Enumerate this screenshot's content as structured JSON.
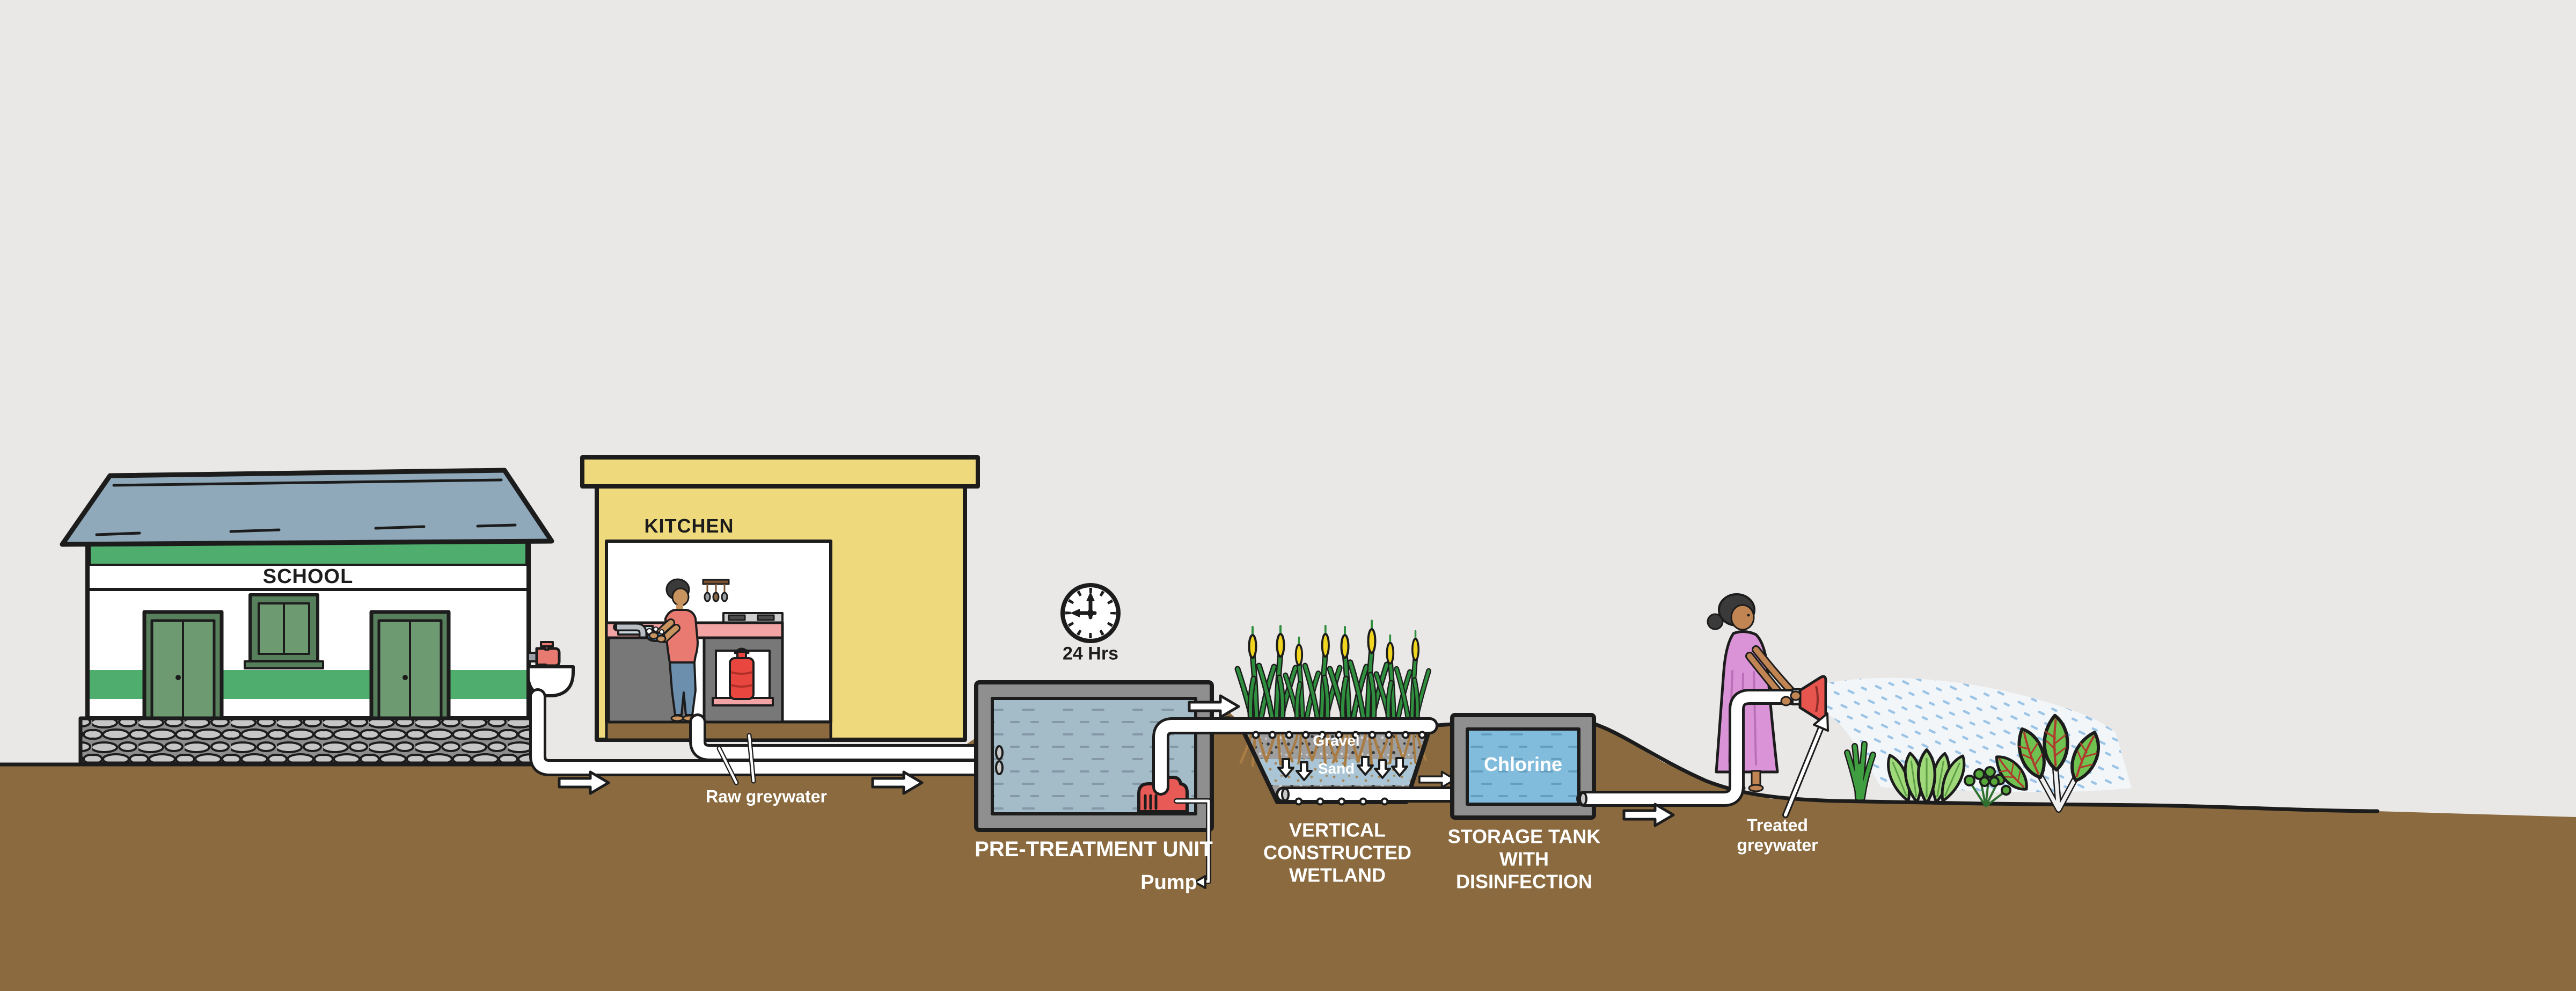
{
  "diagram": {
    "subject": "School greywater treatment and reuse system",
    "labels": {
      "school": "SCHOOL",
      "kitchen": "KITCHEN",
      "duration": "24 Hrs",
      "raw_greywater": "Raw greywater",
      "pretreatment_unit": "PRE-TREATMENT UNIT",
      "pump": "Pump",
      "wetland": "VERTICAL CONSTRUCTED WETLAND",
      "storage_tank": "STORAGE TANK WITH DISINFECTION",
      "chlorine": "Chlorine",
      "gravel": "Gravel",
      "sand": "Sand",
      "treated_greywater": "Treated greywater"
    },
    "icons": {
      "clock": "clock-icon",
      "flow": "arrow-right-icon",
      "percolation": "arrow-down-icon"
    }
  },
  "palette": {
    "bg": "#e9e8e6",
    "ink": "#1c1c1c",
    "ground": "#8a6a3e",
    "roof": "#8fa9ba",
    "school-green": "#4fae6d",
    "door-green": "#6e9a72",
    "door-dark": "#587f5c",
    "kitchen-yellow": "#eed97c",
    "counter-pink": "#f2a3a3",
    "cabinet-grey": "#787878",
    "stove-grey": "#cfcfcf",
    "lpg-red": "#e8463e",
    "tank-grey": "#8f8f8f",
    "water-grey": "#a4bbc8",
    "water-grey-dash": "#8498a6",
    "water-blue": "#82bcdc",
    "water-blue-dash": "#639fc0",
    "pump-red": "#e85a55",
    "gravel-grey": "#9e9e9e",
    "sand-blue": "#aac6d6",
    "sand-dot": "#a5855a",
    "reed-green": "#2f8f3e",
    "cattail-yellow": "#f2d51f",
    "root-brown": "#a97c44",
    "dress-pink": "#d993d6",
    "dress-fold": "#bb6fb8",
    "skin-woman": "#c08552",
    "skin-man": "#c9935f",
    "hair": "#3a3a3a",
    "shirt-red": "#e87a72",
    "jeans-blue": "#6d8fae",
    "spray-blue": "#9cc4e6",
    "spray-base": "#f3f7fb",
    "nozzle-red": "#e8554e",
    "onion-green": "#3f9e3f",
    "lettuce-green": "#9fd97a",
    "parsley-green": "#57a83b",
    "chard-green": "#6fc24f",
    "chard-vein": "#b03a2e",
    "stone": "#c6c6c6",
    "stone-bg": "#8e8e8e",
    "dish-blue": "#4a90d9",
    "water-stream": "#7ab8e8"
  }
}
